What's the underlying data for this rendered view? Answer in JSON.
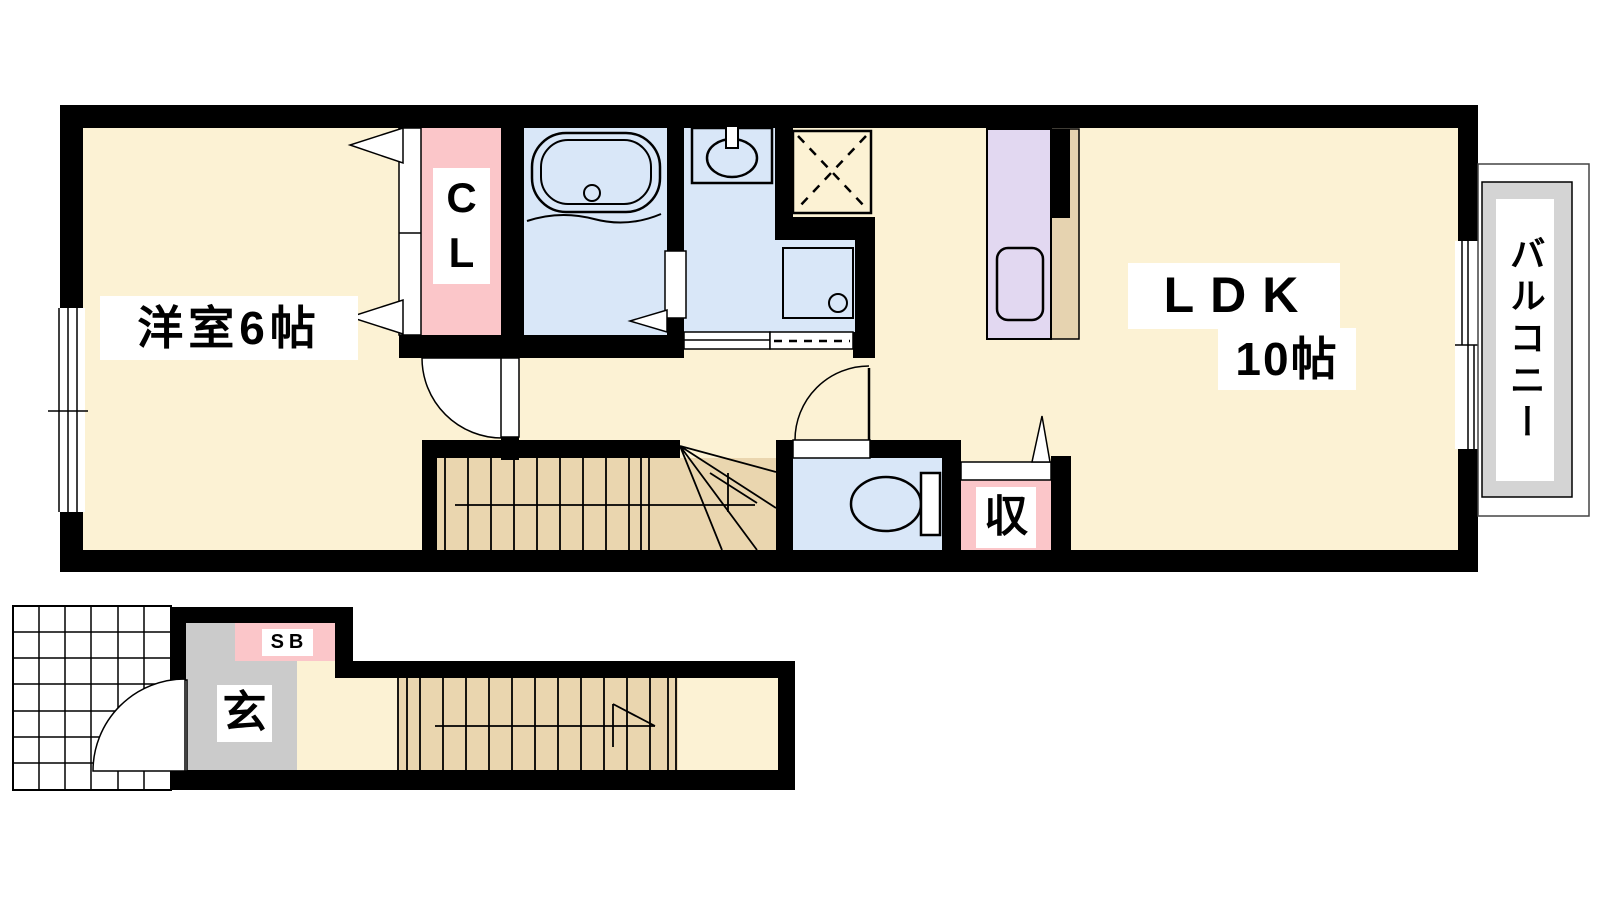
{
  "labels": {
    "western_room": "洋室6帖",
    "closet": "C\nL",
    "ldk": "LDK",
    "ldk_size": "10帖",
    "storage": "収",
    "balcony": "バルコニー",
    "entrance": "玄",
    "shoe_box": "SB"
  },
  "colors": {
    "wall": "#000000",
    "floor_cream": "#fcf2d4",
    "wet_area_blue": "#d9e7f8",
    "closet_pink": "#fbc6c9",
    "kitchen_purple": "#e2d8f1",
    "stairs_beige": "#ead6af",
    "entrance_gray": "#cbcbcb",
    "balcony_gray": "#d4d4d4"
  }
}
